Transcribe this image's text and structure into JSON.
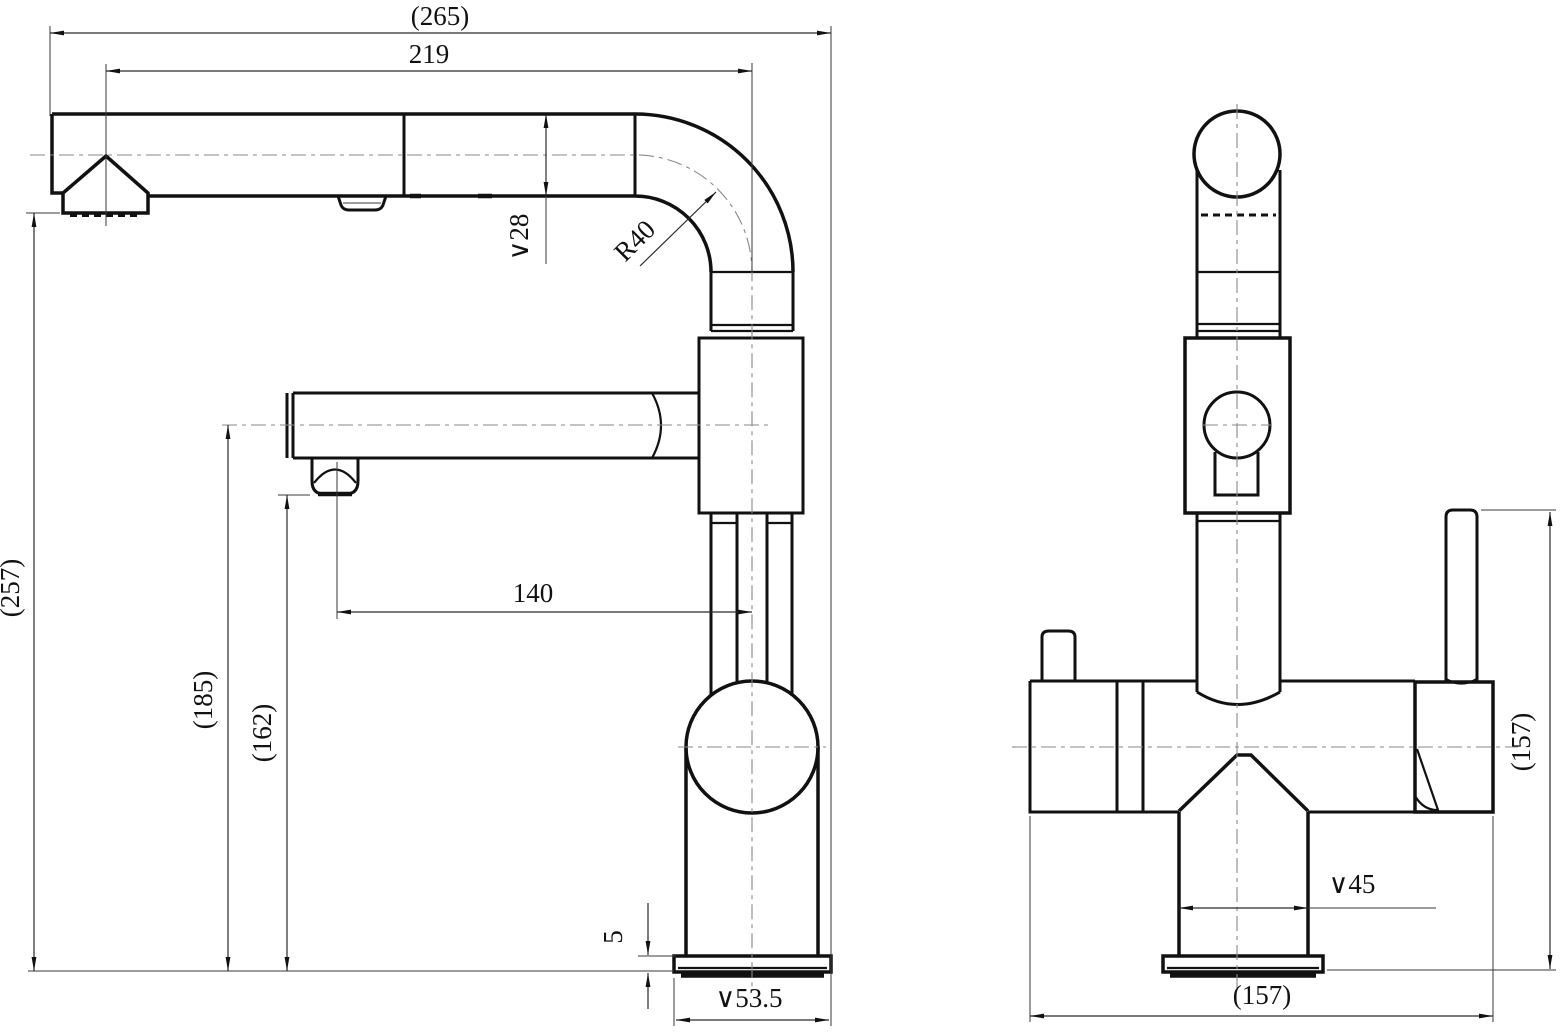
{
  "dimensions": {
    "overall_length": "(265)",
    "spout_reach": "219",
    "spout_diameter": "∨28",
    "bend_radius": "R40",
    "overall_height": "(257)",
    "spray_arm_height": "(185)",
    "spray_outlet_height": "(162)",
    "spray_arm_reach": "140",
    "base_plate_thickness": "5",
    "base_diameter": "∨53.5",
    "shank_diameter": "∨45",
    "front_view_height": "(157)",
    "front_view_width": "(157)"
  }
}
